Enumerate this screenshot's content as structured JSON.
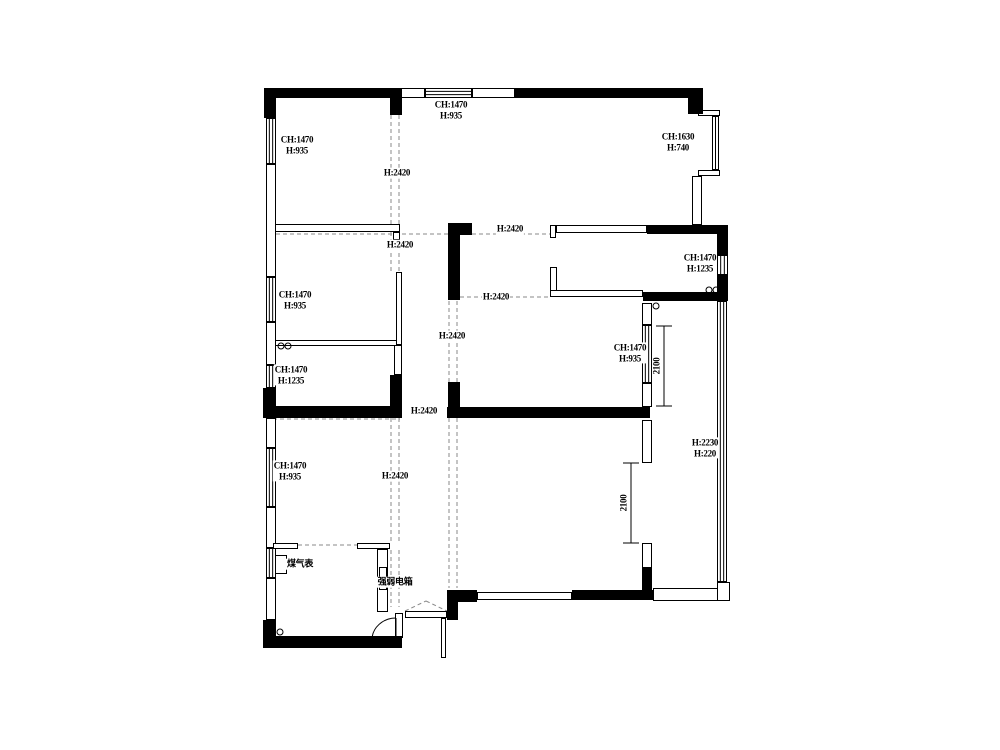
{
  "canvas": {
    "width": 1000,
    "height": 750,
    "bg": "#ffffff",
    "ink": "#000000",
    "dash_color": "#8a8a8a"
  },
  "labels": [
    {
      "lines": [
        "CH:1470",
        "H:935"
      ],
      "x": 297,
      "y": 145,
      "rot": false
    },
    {
      "lines": [
        "CH:1470",
        "H:935"
      ],
      "x": 451,
      "y": 110,
      "rot": false
    },
    {
      "lines": [
        "CH:1630",
        "H:740"
      ],
      "x": 678,
      "y": 142,
      "rot": false
    },
    {
      "lines": [
        "CH:1470",
        "H:935"
      ],
      "x": 295,
      "y": 300,
      "rot": false
    },
    {
      "lines": [
        "CH:1470",
        "H:1235"
      ],
      "x": 291,
      "y": 375,
      "rot": false
    },
    {
      "lines": [
        "CH:1470",
        "H:1235"
      ],
      "x": 700,
      "y": 263,
      "rot": false
    },
    {
      "lines": [
        "CH:1470",
        "H:935"
      ],
      "x": 630,
      "y": 353,
      "rot": false
    },
    {
      "lines": [
        "CH:1470",
        "H:935"
      ],
      "x": 290,
      "y": 471,
      "rot": false
    },
    {
      "lines": [
        "H:2230",
        "H:220"
      ],
      "x": 705,
      "y": 448,
      "rot": false
    },
    {
      "lines": [
        "H:2420"
      ],
      "x": 397,
      "y": 173,
      "rot": false
    },
    {
      "lines": [
        "H:2420"
      ],
      "x": 400,
      "y": 245,
      "rot": false
    },
    {
      "lines": [
        "H:2420"
      ],
      "x": 510,
      "y": 229,
      "rot": false
    },
    {
      "lines": [
        "H:2420"
      ],
      "x": 496,
      "y": 297,
      "rot": false
    },
    {
      "lines": [
        "H:2420"
      ],
      "x": 452,
      "y": 336,
      "rot": false
    },
    {
      "lines": [
        "H:2420"
      ],
      "x": 424,
      "y": 411,
      "rot": false
    },
    {
      "lines": [
        "H:2420"
      ],
      "x": 395,
      "y": 476,
      "rot": false
    },
    {
      "lines": [
        "2100"
      ],
      "x": 657,
      "y": 366,
      "rot": true
    },
    {
      "lines": [
        "2100"
      ],
      "x": 624,
      "y": 503,
      "rot": true
    },
    {
      "lines": [
        "煤气表"
      ],
      "x": 300,
      "y": 564,
      "rot": false
    },
    {
      "lines": [
        "强弱电箱"
      ],
      "x": 395,
      "y": 582,
      "rot": false
    }
  ],
  "floorplan": {
    "solid_walls": [
      [
        264,
        88,
        138,
        10
      ],
      [
        515,
        88,
        188,
        10
      ],
      [
        264,
        88,
        12,
        30
      ],
      [
        688,
        98,
        15,
        16
      ],
      [
        390,
        88,
        12,
        27
      ],
      [
        263,
        388,
        13,
        30
      ],
      [
        263,
        620,
        13,
        28
      ],
      [
        264,
        636,
        138,
        12
      ],
      [
        264,
        406,
        138,
        12
      ],
      [
        390,
        375,
        12,
        43
      ],
      [
        447,
        590,
        30,
        12
      ],
      [
        447,
        600,
        11,
        20
      ],
      [
        572,
        590,
        81,
        10
      ],
      [
        448,
        223,
        24,
        12
      ],
      [
        448,
        235,
        12,
        65
      ],
      [
        448,
        382,
        12,
        36
      ],
      [
        447,
        407,
        203,
        11
      ],
      [
        643,
        292,
        85,
        9
      ],
      [
        647,
        225,
        75,
        9
      ],
      [
        717,
        225,
        11,
        30
      ],
      [
        717,
        275,
        11,
        26
      ],
      [
        642,
        567,
        10,
        26
      ]
    ],
    "outline_walls": [
      [
        400,
        88,
        25,
        10
      ],
      [
        472,
        88,
        43,
        10
      ],
      [
        266,
        164,
        10,
        113
      ],
      [
        266,
        322,
        10,
        43
      ],
      [
        266,
        418,
        10,
        30
      ],
      [
        266,
        507,
        10,
        41
      ],
      [
        266,
        578,
        10,
        42
      ],
      [
        692,
        176,
        10,
        49
      ],
      [
        477,
        592,
        95,
        8
      ],
      [
        653,
        588,
        77,
        13
      ],
      [
        717,
        582,
        13,
        19
      ],
      [
        395,
        613,
        8,
        25
      ],
      [
        394,
        345,
        8,
        30
      ],
      [
        642,
        303,
        10,
        22
      ],
      [
        642,
        383,
        10,
        24
      ],
      [
        642,
        420,
        10,
        43
      ],
      [
        642,
        543,
        10,
        25
      ],
      [
        698,
        110,
        22,
        6
      ],
      [
        698,
        170,
        22,
        6
      ],
      [
        275,
        224,
        125,
        8
      ],
      [
        393,
        232,
        7,
        8
      ],
      [
        275,
        340,
        125,
        6
      ],
      [
        396,
        272,
        6,
        73
      ],
      [
        273,
        543,
        25,
        6
      ],
      [
        357,
        543,
        33,
        6
      ],
      [
        377,
        549,
        11,
        63
      ],
      [
        275,
        555,
        12,
        19
      ],
      [
        379,
        567,
        8,
        23
      ],
      [
        550,
        225,
        6,
        13
      ],
      [
        556,
        225,
        91,
        8
      ],
      [
        550,
        267,
        7,
        25
      ],
      [
        550,
        290,
        93,
        7
      ]
    ],
    "windows": [
      {
        "r": [
          425,
          88,
          47,
          10
        ],
        "dir": "h",
        "n": 2
      },
      {
        "r": [
          266,
          118,
          10,
          46
        ],
        "dir": "v",
        "n": 2
      },
      {
        "r": [
          266,
          277,
          10,
          45
        ],
        "dir": "v",
        "n": 2
      },
      {
        "r": [
          266,
          365,
          10,
          23
        ],
        "dir": "v",
        "n": 2
      },
      {
        "r": [
          266,
          448,
          10,
          59
        ],
        "dir": "v",
        "n": 2
      },
      {
        "r": [
          266,
          548,
          10,
          30
        ],
        "dir": "v",
        "n": 2
      },
      {
        "r": [
          717,
          255,
          11,
          20
        ],
        "dir": "v",
        "n": 2
      },
      {
        "r": [
          642,
          325,
          10,
          58
        ],
        "dir": "v",
        "n": 2
      },
      {
        "r": [
          712,
          116,
          7,
          54
        ],
        "dir": "v",
        "n": 1
      },
      {
        "r": [
          717,
          301,
          10,
          281
        ],
        "dir": "v",
        "n": 2
      }
    ],
    "dashed": [
      [
        391,
        115,
        391,
        224
      ],
      [
        399,
        115,
        399,
        224
      ],
      [
        391,
        232,
        391,
        272
      ],
      [
        399,
        232,
        399,
        272
      ],
      [
        391,
        418,
        391,
        543
      ],
      [
        399,
        418,
        399,
        543
      ],
      [
        391,
        550,
        391,
        607
      ],
      [
        399,
        550,
        399,
        607
      ],
      [
        449,
        301,
        449,
        382
      ],
      [
        457,
        301,
        457,
        382
      ],
      [
        449,
        418,
        449,
        588
      ],
      [
        457,
        418,
        457,
        588
      ],
      [
        276,
        234,
        550,
        234
      ],
      [
        460,
        297,
        550,
        297
      ],
      [
        298,
        545,
        357,
        545
      ],
      [
        266,
        419,
        400,
        419
      ],
      [
        405,
        611,
        426,
        601
      ],
      [
        426,
        601,
        447,
        611
      ]
    ],
    "circles": [
      [
        281,
        346
      ],
      [
        288,
        346
      ],
      [
        709,
        290
      ],
      [
        716,
        290
      ],
      [
        656,
        306
      ],
      [
        280,
        632
      ]
    ],
    "dims": [
      {
        "x": 664,
        "y1": 326,
        "y2": 406,
        "cap": 8
      },
      {
        "x": 631,
        "y1": 463,
        "y2": 543,
        "cap": 8
      }
    ],
    "doors": {
      "entry_sill": [
        405,
        611,
        42,
        7
      ],
      "entry_leaf": [
        441,
        618,
        5,
        40
      ],
      "swing_arc": "M 396 618 A 24 22 0 0 0 372 640",
      "swing_leaf": [
        396,
        618,
        396,
        640
      ]
    }
  }
}
